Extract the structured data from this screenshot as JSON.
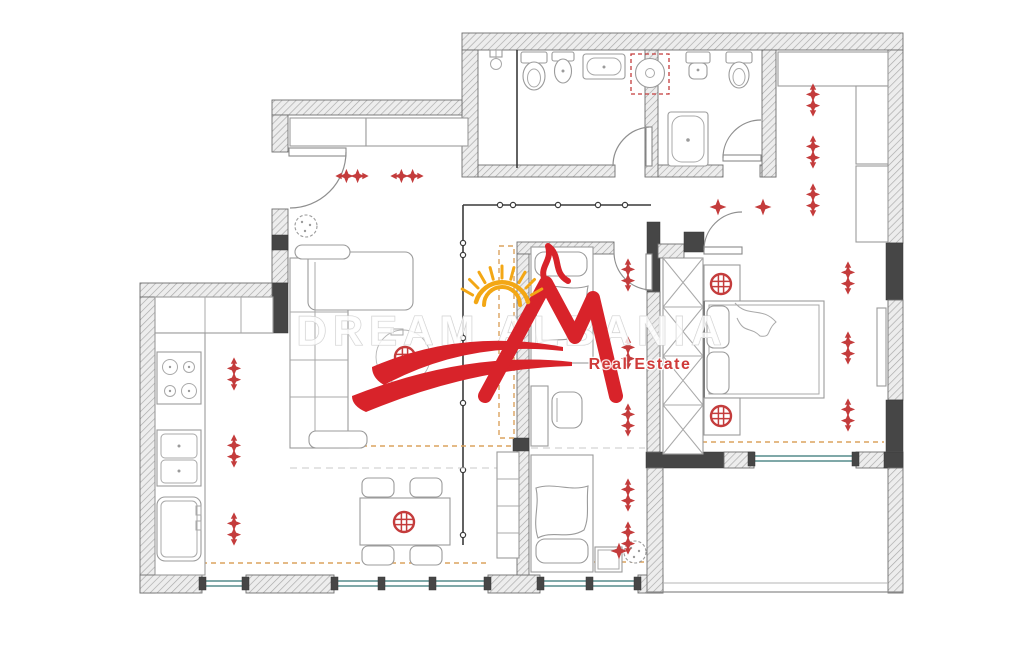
{
  "watermark": {
    "brand": "DREAM ALBANIA",
    "tagline": "Real Estate"
  },
  "colors": {
    "logo_red": "#d8232a",
    "sun_yellow": "#f3a715",
    "symbol_red": "#c43c3c",
    "wall_dark": "#464646",
    "wall_hatch_bg": "#ededed",
    "window_teal": "#7fa8a8",
    "heating_dashed_orange": "#dca35f",
    "furniture_gray": "#9b9b9b"
  },
  "electrical_symbols": {
    "types": {
      "spot-v": "ceiling-spotlight",
      "spot-h": "ceiling-spotlight",
      "diamond": "point-light",
      "chand": "chandelier"
    },
    "items": [
      {
        "type": "spot-v",
        "x": 234,
        "y": 374
      },
      {
        "type": "spot-v",
        "x": 234,
        "y": 451
      },
      {
        "type": "spot-v",
        "x": 234,
        "y": 529
      },
      {
        "type": "spot-v",
        "x": 628,
        "y": 275
      },
      {
        "type": "spot-v",
        "x": 628,
        "y": 353
      },
      {
        "type": "spot-v",
        "x": 628,
        "y": 420
      },
      {
        "type": "spot-v",
        "x": 628,
        "y": 495
      },
      {
        "type": "spot-v",
        "x": 628,
        "y": 538
      },
      {
        "type": "spot-v",
        "x": 848,
        "y": 278
      },
      {
        "type": "spot-v",
        "x": 848,
        "y": 348
      },
      {
        "type": "spot-v",
        "x": 848,
        "y": 415
      },
      {
        "type": "spot-v",
        "x": 813,
        "y": 100
      },
      {
        "type": "spot-v",
        "x": 813,
        "y": 152
      },
      {
        "type": "spot-v",
        "x": 813,
        "y": 200
      },
      {
        "type": "spot-h",
        "x": 352,
        "y": 176
      },
      {
        "type": "spot-h",
        "x": 407,
        "y": 176
      },
      {
        "type": "diamond",
        "x": 718,
        "y": 207
      },
      {
        "type": "diamond",
        "x": 763,
        "y": 207
      },
      {
        "type": "diamond",
        "x": 619,
        "y": 551
      },
      {
        "type": "chand",
        "x": 405,
        "y": 357
      },
      {
        "type": "chand",
        "x": 404,
        "y": 522
      },
      {
        "type": "chand",
        "x": 721,
        "y": 284
      },
      {
        "type": "chand",
        "x": 721,
        "y": 416
      }
    ]
  }
}
